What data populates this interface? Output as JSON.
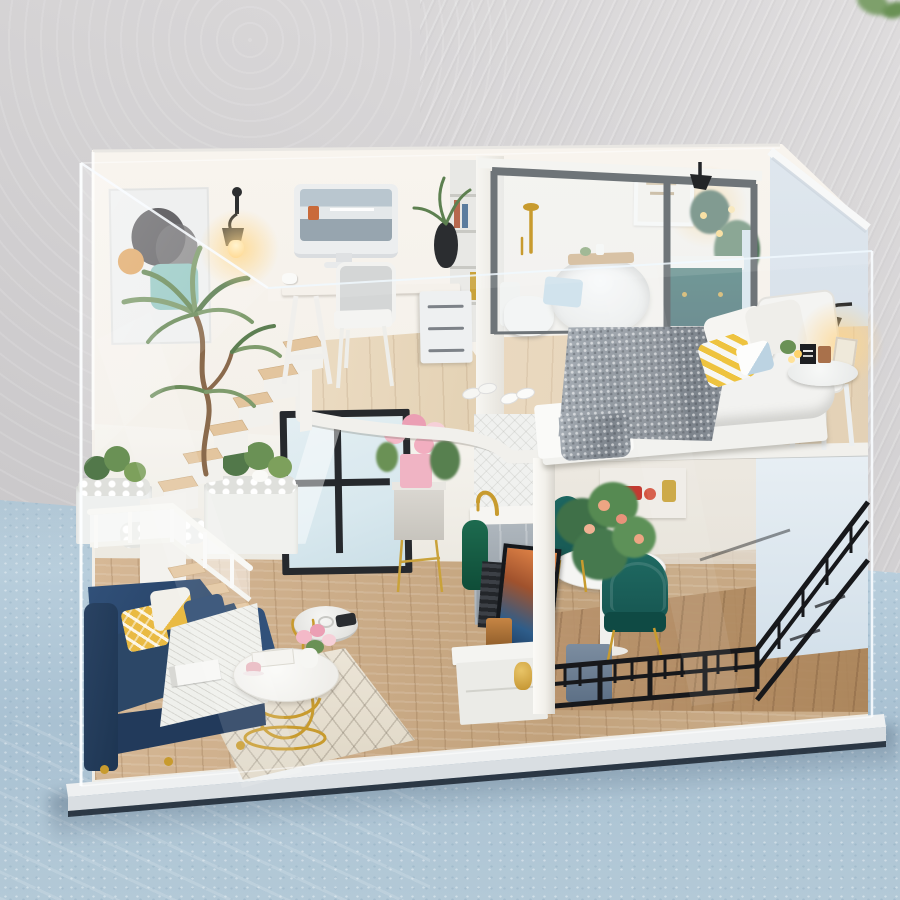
{
  "caption": "Miniature two-story loft dollhouse kit displayed inside a clear acrylic dust cover on a light blue surface against a textured gray wall",
  "palette": {
    "wall1": "#dedcdd",
    "wall2": "#c9c7c9",
    "ground1": "#c3d7e3",
    "ground2": "#a9c1d2",
    "houseWall": "#f4f2ec",
    "wallWarm": "#f8f4ee",
    "rightWall": "#dfe7ee",
    "woodUp": "#e6d5ba",
    "woodBed": "#ead9c0",
    "woodMain": "#cfae8a",
    "woodDeck": "#b9946e",
    "stairWood": "#e3c59e",
    "fascia": "#f1f0ec",
    "columnW": "#f2f0ea",
    "sofa": "#2c4767",
    "sofaDark": "#223a5b",
    "sofaLight": "#31517a",
    "yellow": "#e9ba43",
    "throw": "#eff0ec",
    "rug": "#e9e2d4",
    "gold": "#c89b2e",
    "green": "#6a9155",
    "greenDark": "#335c49",
    "teal": "#175752",
    "tealCab": "#12474c",
    "railing": "#17181b",
    "glassFrame": "#6e7478",
    "winFrame": "#26292d",
    "winGlass": "#d8e8ee",
    "blanket": "#99a0a8",
    "bedWhite": "#f2f2f0",
    "glow": "#ffd68c",
    "towelGreen": "#176b4e",
    "towelBlue": "#bcd8e7",
    "tile": "#f0f1ef",
    "amber": "#b97c3e",
    "red": "#c23a31",
    "pinkRose": "#f0b4c4",
    "peach": "#eda583",
    "slate": "#6e7f96",
    "tvDark": "#15181c",
    "vac": "#ececea",
    "baseTop": "#eef0f1",
    "art1": "#5b5b5e",
    "art2": "#93c8c3",
    "art3": "#e0a45f",
    "cup": "#a9714b"
  },
  "scene": {
    "setting": [
      "textured-gray-wall",
      "light-blue-surface",
      "white-display-base",
      "clear-acrylic-cover"
    ],
    "upper_floor": [
      "abstract-wall-art",
      "wall-sconce",
      "palm-plant",
      "imac-monitor",
      "trestle-desk",
      "white-desk-chair",
      "black-vase-plant",
      "drawer-unit",
      "bookshelf",
      "bathroom-glass-partition",
      "gold-shower",
      "toilet",
      "round-bathtub",
      "bath-tray",
      "blue-towel",
      "teal-vanity",
      "botanical-art",
      "bathroom-sconce",
      "bathroom-plant",
      "double-bed",
      "gray-knit-blanket",
      "white-pillows",
      "yellow-triangle-pillow",
      "headboard",
      "bedside-stool",
      "reading-lamp",
      "slippers"
    ],
    "lower_floor": [
      "floating-staircase",
      "white-stair-railing",
      "pebble-planters",
      "green-shrubs",
      "black-frame-window",
      "navy-sofa",
      "yellow-pillows",
      "white-knit-throw",
      "magazine",
      "diamond-rug",
      "gold-coffee-table",
      "pink-roses",
      "robot-vacuum",
      "flower-stand",
      "kitchen-tile-wall",
      "gold-faucet",
      "kitchen-cabinet",
      "green-towel",
      "tv-screen",
      "speaker",
      "amber-box",
      "media-console",
      "gold-jar",
      "support-column",
      "dining-table",
      "teal-dining-chairs",
      "dining-plant",
      "red-dishes-shelf",
      "black-balcony-railing",
      "wood-deck"
    ]
  }
}
